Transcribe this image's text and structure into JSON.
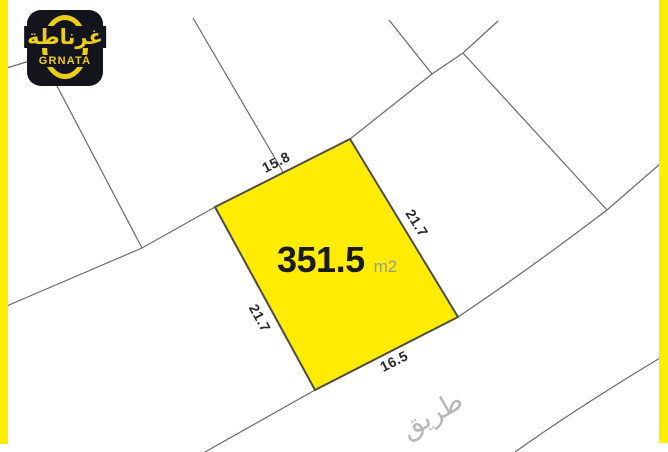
{
  "meta": {
    "background_color": "#ffffff",
    "frame_color": "#ffee00",
    "boundary_line_color": "#6a6a6a"
  },
  "logo": {
    "arabic_name": "غرناطة",
    "latin_name": "GRNATA",
    "badge_color": "#14141d",
    "accent_color": "#edce16"
  },
  "plot": {
    "fill": "#ffec00",
    "border_color": "#4f4d42",
    "area_value": "351.5",
    "area_unit": "m2",
    "dimensions": {
      "top": "15.8",
      "right": "21.7",
      "left": "21.7",
      "bottom": "16.5"
    }
  },
  "road": {
    "label": "طريق"
  }
}
